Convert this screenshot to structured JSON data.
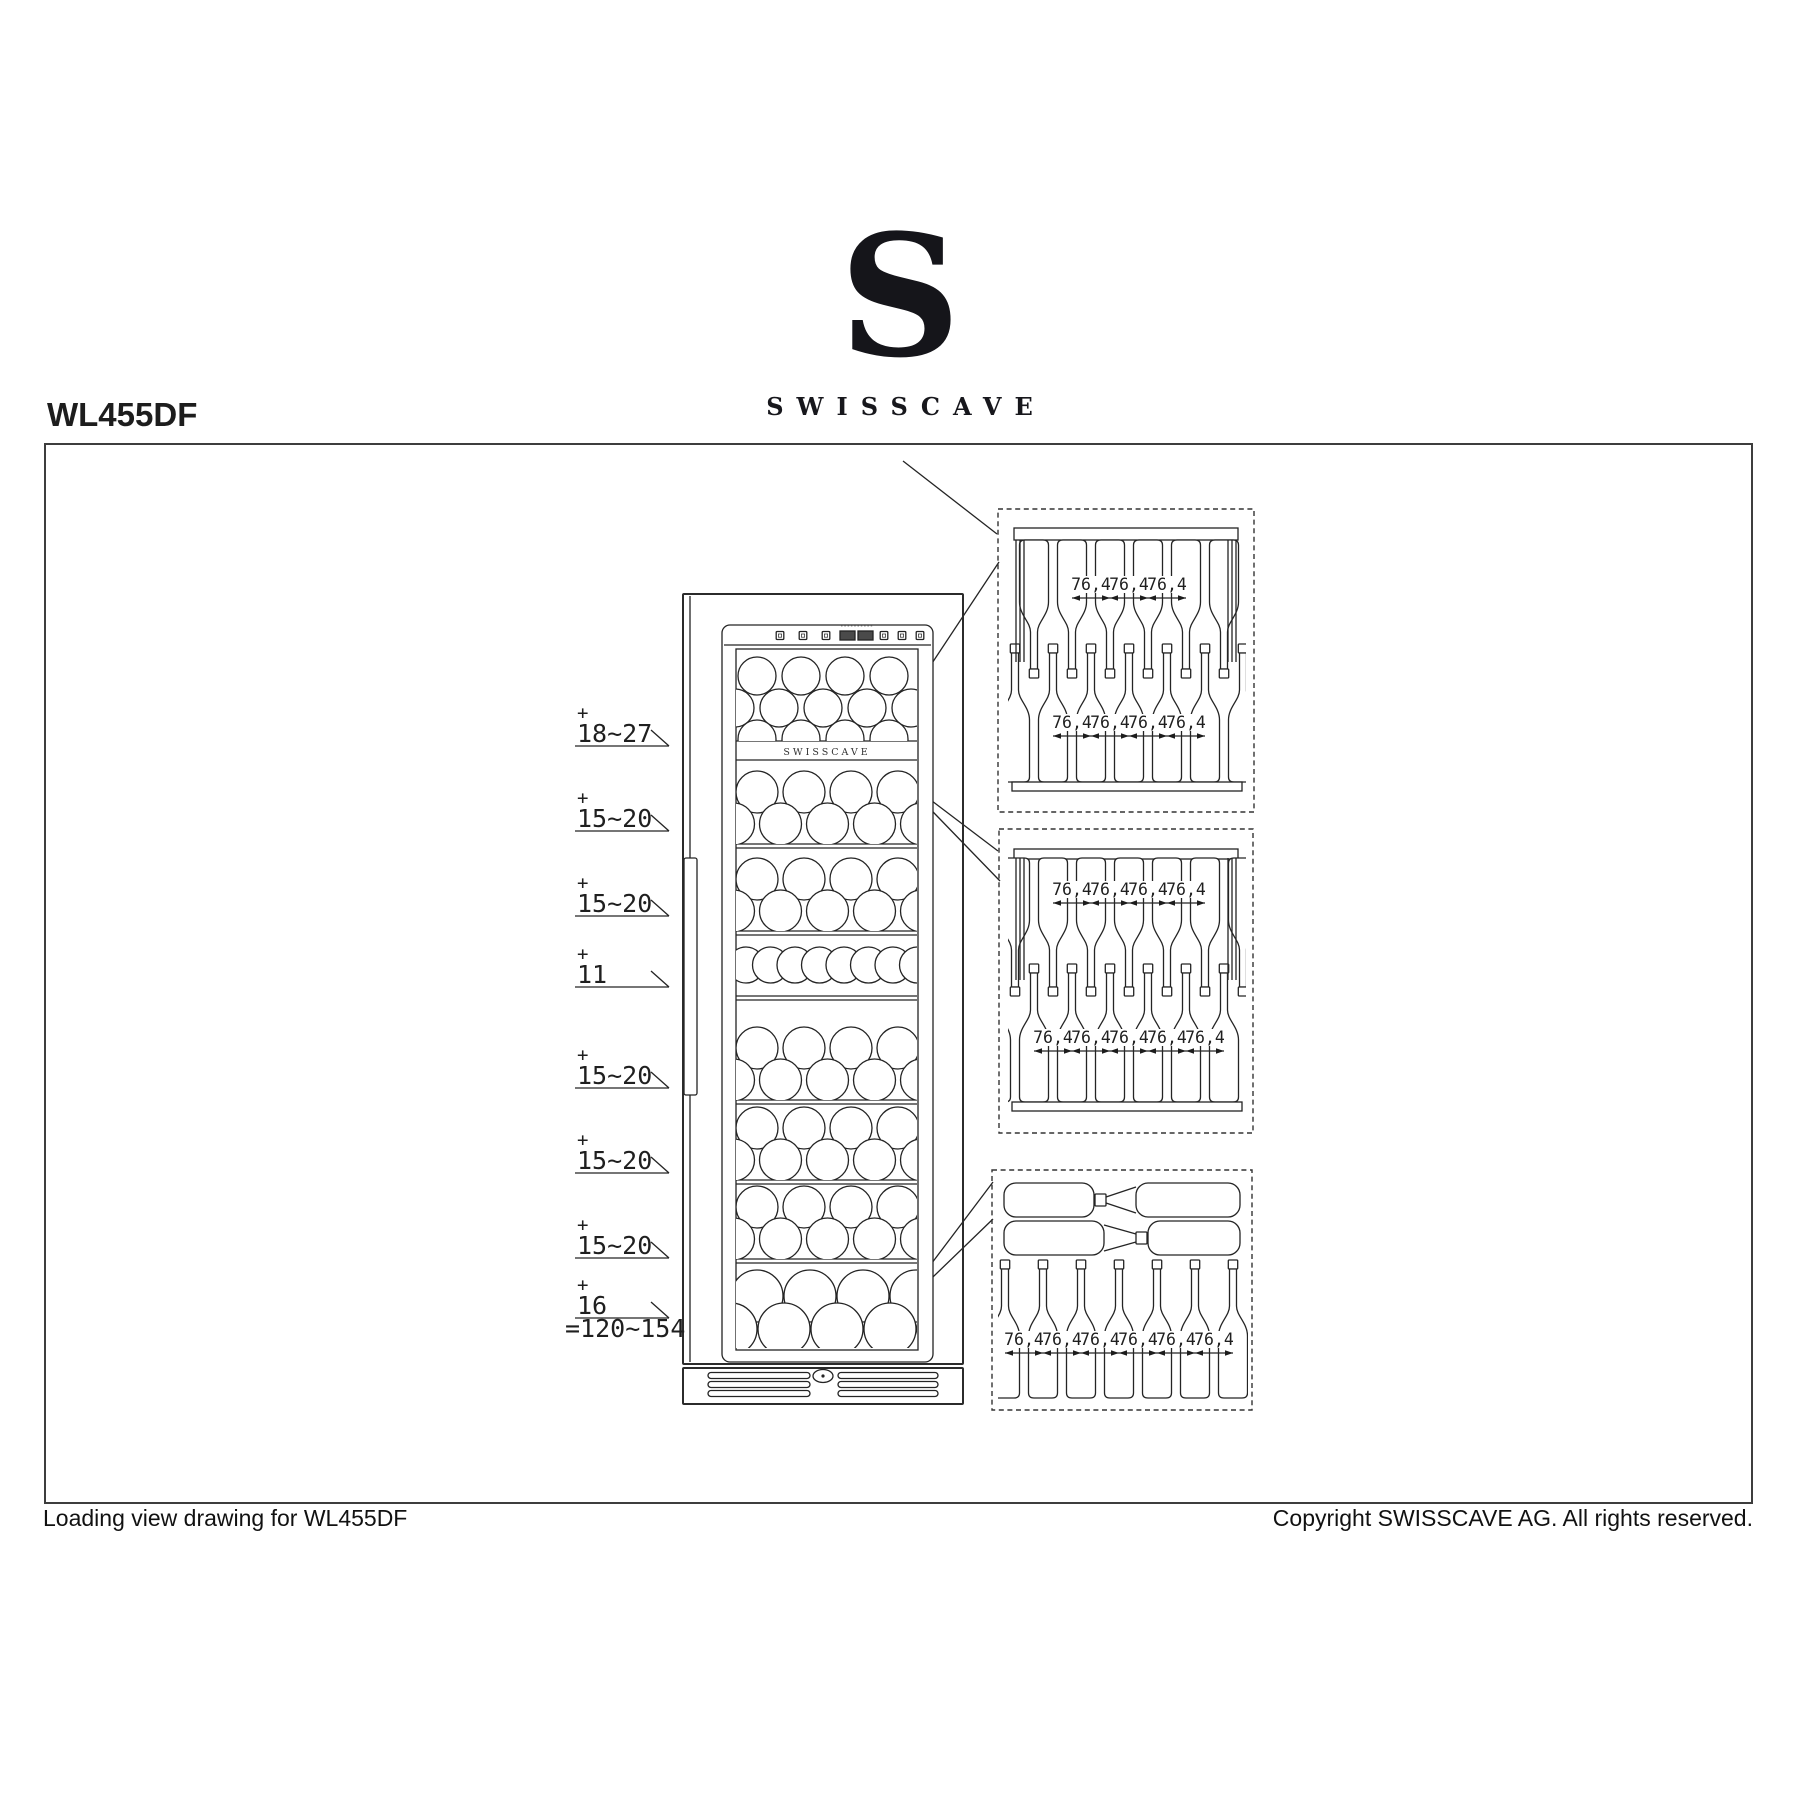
{
  "page": {
    "title": "WL455DF"
  },
  "logo": {
    "mark": "S",
    "wordmark": "SWISSCAVE"
  },
  "fridge": {
    "brand_label": "SWISSCAVE"
  },
  "zones": [
    {
      "plus": "+",
      "value": "18~27"
    },
    {
      "plus": "+",
      "value": "15~20"
    },
    {
      "plus": "+",
      "value": "15~20"
    },
    {
      "plus": "+",
      "value": "11"
    },
    {
      "plus": "+",
      "value": "15~20"
    },
    {
      "plus": "+",
      "value": "15~20"
    },
    {
      "plus": "+",
      "value": "15~20"
    },
    {
      "plus": "+",
      "value": "16"
    }
  ],
  "zones_total": "=120~154",
  "dimension_label": "76,4",
  "detail_boxes": [
    {
      "name": "upper-shelf-detail",
      "top_dim_count": 3,
      "bottom_dim_count": 4
    },
    {
      "name": "middle-shelf-detail",
      "top_dim_count": 4,
      "bottom_dim_count": 5
    },
    {
      "name": "bottom-shelf-detail",
      "bottom_dim_count": 6
    }
  ],
  "footer": {
    "left": "Loading view drawing for WL455DF",
    "right": "Copyright SWISSCAVE AG. All rights reserved."
  }
}
